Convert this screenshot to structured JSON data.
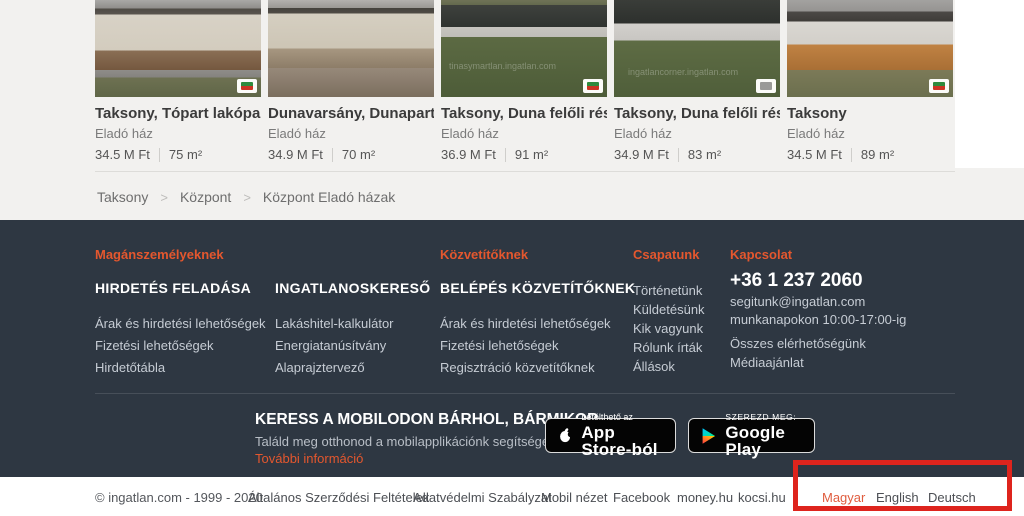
{
  "listings": {
    "cards": [
      {
        "title": "Taksony, Tópart lakópark...",
        "category": "Eladó ház",
        "price": "34.5 M Ft",
        "area": "75 m²",
        "watermark": ""
      },
      {
        "title": "Dunavarsány, Dunapart, ...",
        "category": "Eladó ház",
        "price": "34.9 M Ft",
        "area": "70 m²",
        "watermark": ""
      },
      {
        "title": "Taksony, Duna felőli rész...",
        "category": "Eladó ház",
        "price": "36.9 M Ft",
        "area": "91 m²",
        "watermark": "tinasymartlan.ingatlan.com"
      },
      {
        "title": "Taksony, Duna felőli rész...",
        "category": "Eladó ház",
        "price": "34.9 M Ft",
        "area": "83 m²",
        "watermark": "ingatlancorner.ingatlan.com"
      },
      {
        "title": "Taksony",
        "category": "Eladó ház",
        "price": "34.5 M Ft",
        "area": "89 m²",
        "watermark": ""
      }
    ]
  },
  "breadcrumb": {
    "separator": ">",
    "items": [
      "Taksony",
      "Központ",
      "Központ Eladó házak"
    ]
  },
  "footer": {
    "private": {
      "header": "Magánszemélyeknek",
      "groups": [
        {
          "heading": "HIRDETÉS FELADÁSA",
          "links": [
            "Árak és hirdetési lehetőségek",
            "Fizetési lehetőségek",
            "Hirdetőtábla"
          ]
        },
        {
          "heading": "INGATLANOSKERESŐ",
          "links": [
            "Lakáshitel-kalkulátor",
            "Energiatanúsítvány",
            "Alaprajztervező"
          ]
        }
      ]
    },
    "agents": {
      "header": "Közvetítőknek",
      "heading": "BELÉPÉS KÖZVETÍTŐKNEK",
      "links": [
        "Árak és hirdetési lehetőségek",
        "Fizetési lehetőségek",
        "Regisztráció közvetítőknek"
      ]
    },
    "team": {
      "header": "Csapatunk",
      "links": [
        "Történetünk",
        "Küldetésünk",
        "Kik vagyunk",
        "Rólunk írták",
        "Állások"
      ]
    },
    "contact": {
      "header": "Kapcsolat",
      "phone": "+36 1 237 2060",
      "email": "segitunk@ingatlan.com",
      "hours": "munkanapokon 10:00-17:00-ig",
      "links": [
        "Összes elérhetőségünk",
        "Médiaajánlat"
      ]
    },
    "mobile": {
      "title": "KERESS A MOBILODON BÁRHOL, BÁRMIKOR",
      "subtitle": "Találd meg otthonod a mobilapplikációnk segítségével.",
      "more_link": "További információ"
    },
    "store_badges": {
      "appstore_line1": "Letölthető az",
      "appstore_line2": "App Store-ból",
      "googleplay_line1": "SZEREZD MEG:",
      "googleplay_line2": "Google Play"
    }
  },
  "bottom_bar": {
    "copyright": "© ingatlan.com - 1999 - 2020",
    "links": [
      "Általános Szerződési Feltételek",
      "Adatvédelmi Szabályzat",
      "Mobil nézet",
      "Facebook",
      "money.hu",
      "kocsi.hu"
    ],
    "languages": [
      "Magyar",
      "English",
      "Deutsch"
    ]
  },
  "colors": {
    "accent_orange": "#e4572e",
    "footer_bg": "#2e3742",
    "annotation_red": "#de241d",
    "language_active": "#e05d3f"
  }
}
